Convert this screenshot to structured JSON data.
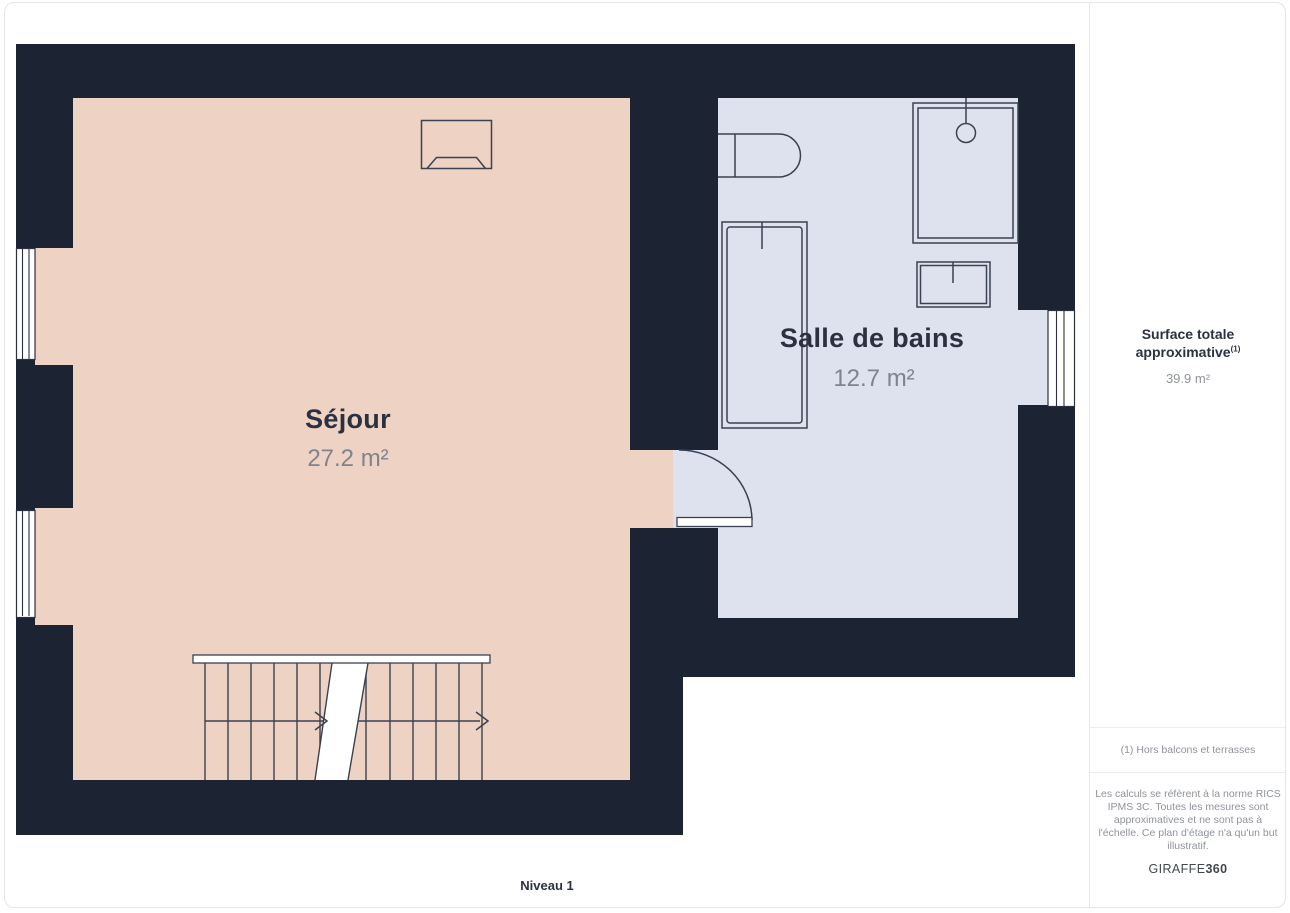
{
  "plan": {
    "level_label": "Niveau 1",
    "rooms": [
      {
        "name": "Séjour",
        "area": "27.2 m²"
      },
      {
        "name": "Salle de bains",
        "area": "12.7 m²"
      }
    ],
    "colors": {
      "wall": "#1c2433",
      "room_sejour_fill": "#eed3c4",
      "room_bath_fill": "#dde2ee",
      "fixture_stroke": "#3a4150",
      "text_primary": "#2b3140",
      "text_secondary": "#8f939b"
    }
  },
  "sidebar": {
    "total_label": "Surface totale approximative",
    "total_superscript": "(1)",
    "total_value": "39.9 m²",
    "footnote": "(1) Hors balcons et terrasses",
    "disclaimer": "Les calculs se réfèrent à la norme RICS\nIPMS 3C. Toutes les mesures sont\napproximatives et ne sont pas à\nl'échelle. Ce plan d'étage n'a qu'un but\nillustratif.",
    "brand_name": "GIRAFFE",
    "brand_suffix": "360"
  }
}
